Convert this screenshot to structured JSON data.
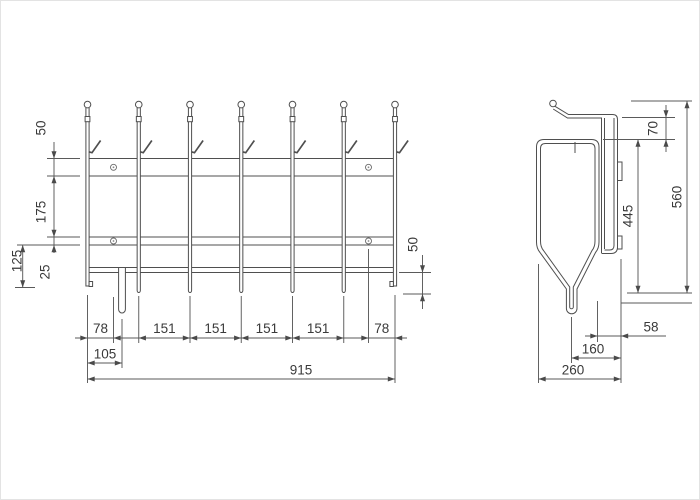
{
  "drawing": {
    "style": {
      "line_color": "#4f4f4f",
      "dim_line_color": "#5a5a5a",
      "text_color": "#3a3a3a",
      "background": "#ffffff"
    },
    "front_view": {
      "dims": {
        "rail_height": "50",
        "rail_gap": "175",
        "mid_rail_height": "25",
        "mid_rail_to_bottom": "125",
        "bar_overhang": "50",
        "bottom_chain": [
          "78",
          "151",
          "151",
          "151",
          "151",
          "78"
        ],
        "hook_offset": "105",
        "total_width": "915"
      }
    },
    "side_view": {
      "dims": {
        "hook_to_basket": "70",
        "basket_height": "445",
        "total_height": "560",
        "basket_to_wall": "58",
        "stub_to_wall": "160",
        "total_depth": "260"
      }
    }
  }
}
